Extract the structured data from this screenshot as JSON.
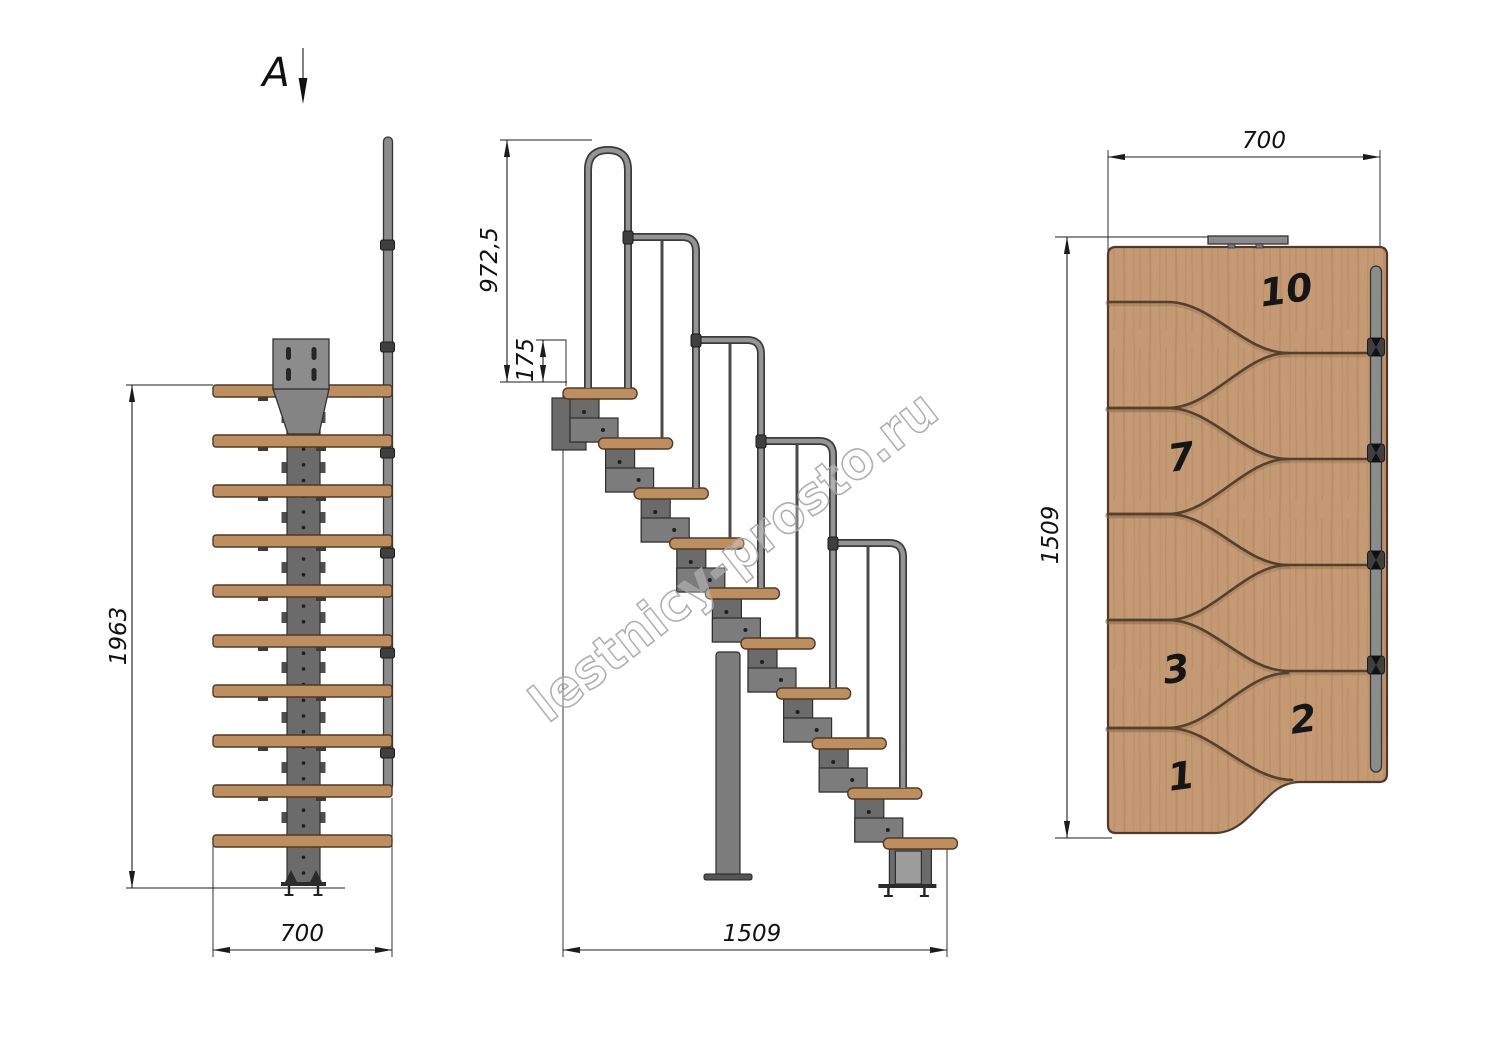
{
  "drawing": {
    "section_marker": {
      "label": "A"
    },
    "watermark": {
      "text": "lestnicy-prosto.ru"
    },
    "front_view": {
      "tread_count": 10,
      "dims": {
        "height": "1963",
        "width": "700"
      }
    },
    "side_view": {
      "tread_count": 10,
      "dims": {
        "handrail_height": "972,5",
        "rise": "175",
        "length": "1509"
      }
    },
    "top_view": {
      "tread_count": 10,
      "dims": {
        "width": "700",
        "length": "1509"
      },
      "steps": [
        {
          "label": "10"
        },
        {
          "label": "7"
        },
        {
          "label": "3"
        },
        {
          "label": "2"
        },
        {
          "label": "1"
        }
      ]
    },
    "colors": {
      "wood": "#bd8e60",
      "wood_edge": "#4f3a28",
      "metal": "#8c8c8c",
      "metal_edge": "#333333",
      "gap_line": "#55402c",
      "dim_line": "#1c1c1c",
      "watermark_gray": "#a6a6a6"
    }
  }
}
